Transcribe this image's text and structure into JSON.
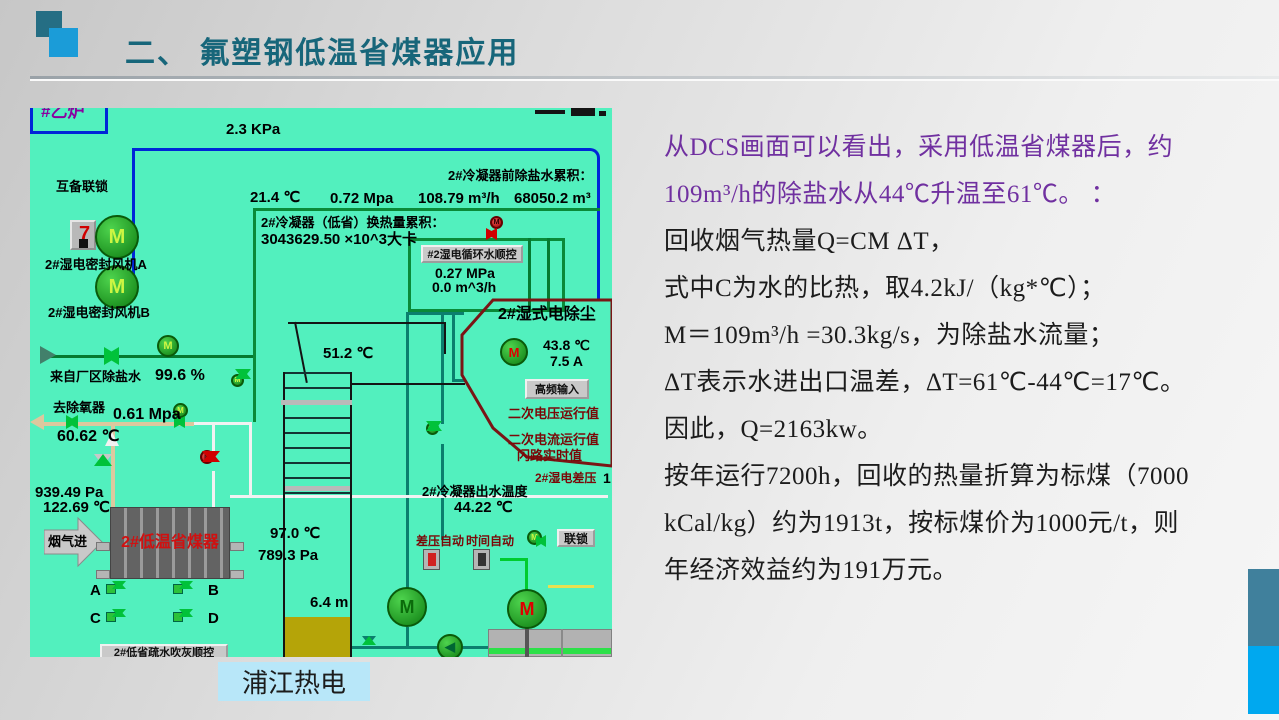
{
  "slide": {
    "title": "二、 氟塑钢低温省煤器应用",
    "caption": "浦江热电"
  },
  "colors": {
    "purple": "#7030a0",
    "ink": "#1c1c1c",
    "title_teal": "#17667a",
    "accent_blue": "#00a8ef",
    "dcs_bg": "#52f0be"
  },
  "body": {
    "lines": [
      {
        "text": "从DCS画面可以看出，采用低温省煤器后，约",
        "color": "#7030a0"
      },
      {
        "text": "109m³/h的除盐水从44℃升温至61℃。 ：",
        "color": "#7030a0"
      },
      {
        "text": "回收烟气热量Q=CM ΔT，",
        "color": "#1c1c1c"
      },
      {
        "text": "式中C为水的比热，取4.2kJ/（kg*℃）；",
        "color": "#1c1c1c"
      },
      {
        "text": "M＝109m³/h =30.3kg/s，为除盐水流量；",
        "color": "#1c1c1c"
      },
      {
        "text": "ΔT表示水进出口温差，ΔT=61℃-44℃=17℃。",
        "color": "#1c1c1c"
      },
      {
        "text": "因此，Q=2163kw。",
        "color": "#1c1c1c"
      },
      {
        "text": "按年运行7200h，回收的热量折算为标煤（7000",
        "color": "#1c1c1c"
      },
      {
        "text": "kCal/kg）约为1913t，按标煤价为1000元/t，则",
        "color": "#1c1c1c"
      },
      {
        "text": "年经济效益约为191万元。",
        "color": "#1c1c1c"
      }
    ]
  },
  "dcs": {
    "m": "M",
    "pump_icon": "◀",
    "interlock_glyph": "7",
    "boiler_tag": "#乙炉",
    "kpa_top": "2.3 KPa",
    "mutual_interlock": "互备联锁",
    "fan_a": "2#湿电密封风机A",
    "fan_b": "2#湿电密封风机B",
    "pre_desal_label": "2#冷凝器前除盐水累积：",
    "pre_desal_value": "68050.2 m³",
    "t_214": "21.4 ℃",
    "p_072": "0.72 Mpa",
    "f_10879": "108.79 m³/h",
    "heat_label": "2#冷凝器（低省）换热量累积：",
    "heat_value": "3043629.50 ×10^3大卡",
    "seq_btn": "#2湿电循环水顺控",
    "p_027": "0.27 MPa",
    "f_00": "0.0 m^3/h",
    "esp_title": "2#湿式电除尘",
    "t_438": "43.8 ℃",
    "a_75": "7.5 A",
    "hf_btn": "高频输入",
    "sec_v": "二次电压运行值",
    "sec_c": "二次电流运行值",
    "flash": "闪路实时值",
    "esp_dp": "2#湿电差压",
    "esp_dp_cut": "1",
    "t_512": "51.2 ℃",
    "from_plant": "来自厂区除盐水",
    "pos_996": "99.6 %",
    "to_deaerator": "去除氧器",
    "p_061": "0.61 Mpa",
    "t_6062": "60.62 ℃",
    "p_93949": "939.49 Pa",
    "t_12269": "122.69 ℃",
    "flue_in": "烟气进",
    "economizer": "2#低温省煤器",
    "t_970": "97.0 ℃",
    "p_7893": "789.3 Pa",
    "v_a": "A",
    "v_b": "B",
    "v_c": "C",
    "v_d": "D",
    "blow_btn": "2#低省疏水吹灰顺控",
    "level": "6.4 m",
    "outlet_label": "2#冷凝器出水温度",
    "outlet_temp": "44.22 ℃",
    "dp_auto": "差压自动",
    "time_auto": "时间自动",
    "lock_btn": "联锁"
  }
}
